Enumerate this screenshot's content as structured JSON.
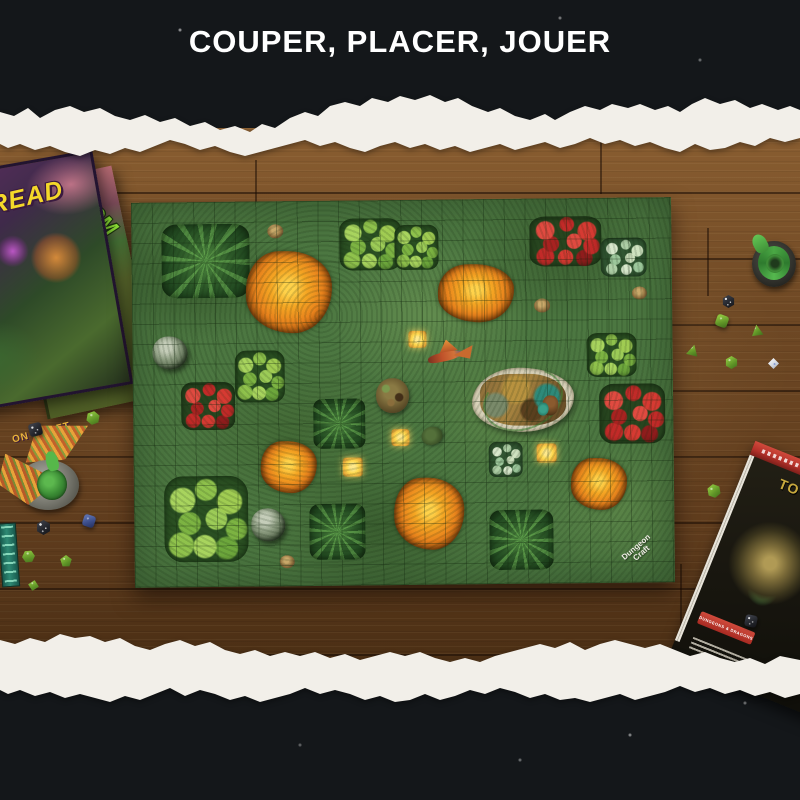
{
  "header": {
    "title": "COUPER, PLACER, JOUER"
  },
  "products": {
    "box_top": {
      "title_fragment": "E DREAD",
      "publisher_fragment": "ON CRAFT"
    },
    "box_bottom": {
      "title_fragment": "DOOM"
    },
    "mat_logo": {
      "line1": "Dungeon",
      "line2": "Craft"
    },
    "book": {
      "title_fragment": "TO",
      "logo_text": "DUNGEONS & DRAGONS"
    }
  },
  "colors": {
    "ink": "#14171a",
    "paper": "#f2efe9",
    "wood": "#6e4824",
    "wood_dark": "#4a2e14",
    "wood_light": "#8a5e31",
    "mat_green": "#4c7741",
    "lava": "#ef9420",
    "glow": "#ffd94f",
    "red_flower": "#c32a26",
    "leaf_light": "#9ccb57",
    "title_yellow": "#f4d829",
    "doom_green": "#96ef3a",
    "book_red": "#b5312a",
    "white": "#ffffff"
  },
  "scene": {
    "terrain": [
      {
        "t": "fern",
        "x": 30,
        "y": 22,
        "w": 88,
        "h": 74
      },
      {
        "t": "bush",
        "x": 208,
        "y": 18,
        "w": 62,
        "h": 52
      },
      {
        "t": "bush",
        "x": 263,
        "y": 25,
        "w": 44,
        "h": 45
      },
      {
        "t": "stump",
        "x": 136,
        "y": 23,
        "w": 16,
        "h": 14
      },
      {
        "t": "lava",
        "x": 114,
        "y": 50,
        "w": 86,
        "h": 82
      },
      {
        "t": "red",
        "x": 398,
        "y": 18,
        "w": 72,
        "h": 50
      },
      {
        "t": "pale",
        "x": 469,
        "y": 40,
        "w": 46,
        "h": 39
      },
      {
        "t": "lava",
        "x": 306,
        "y": 65,
        "w": 76,
        "h": 58
      },
      {
        "t": "stump",
        "x": 402,
        "y": 100,
        "w": 16,
        "h": 14
      },
      {
        "t": "stump",
        "x": 500,
        "y": 89,
        "w": 15,
        "h": 13
      },
      {
        "t": "boulder",
        "x": 20,
        "y": 134,
        "w": 35,
        "h": 33
      },
      {
        "t": "bush",
        "x": 102,
        "y": 149,
        "w": 50,
        "h": 52
      },
      {
        "t": "glow",
        "x": 276,
        "y": 131,
        "w": 18,
        "h": 17
      },
      {
        "t": "bush",
        "x": 454,
        "y": 135,
        "w": 50,
        "h": 44
      },
      {
        "t": "red",
        "x": 48,
        "y": 180,
        "w": 54,
        "h": 48
      },
      {
        "t": "fern",
        "x": 180,
        "y": 198,
        "w": 52,
        "h": 50
      },
      {
        "t": "ruin",
        "x": 339,
        "y": 169,
        "w": 102,
        "h": 64
      },
      {
        "t": "red",
        "x": 466,
        "y": 186,
        "w": 66,
        "h": 60
      },
      {
        "t": "glow",
        "x": 258,
        "y": 229,
        "w": 18,
        "h": 17
      },
      {
        "t": "lava",
        "x": 127,
        "y": 240,
        "w": 56,
        "h": 52
      },
      {
        "t": "glow",
        "x": 209,
        "y": 257,
        "w": 20,
        "h": 19
      },
      {
        "t": "pale",
        "x": 355,
        "y": 243,
        "w": 34,
        "h": 35
      },
      {
        "t": "glow",
        "x": 403,
        "y": 245,
        "w": 20,
        "h": 19
      },
      {
        "t": "lava",
        "x": 437,
        "y": 260,
        "w": 56,
        "h": 52
      },
      {
        "t": "bush",
        "x": 30,
        "y": 274,
        "w": 84,
        "h": 86
      },
      {
        "t": "lava",
        "x": 260,
        "y": 278,
        "w": 70,
        "h": 72
      },
      {
        "t": "boulder",
        "x": 117,
        "y": 307,
        "w": 34,
        "h": 33
      },
      {
        "t": "fern",
        "x": 175,
        "y": 303,
        "w": 56,
        "h": 56
      },
      {
        "t": "fern",
        "x": 355,
        "y": 311,
        "w": 64,
        "h": 60
      },
      {
        "t": "stump",
        "x": 145,
        "y": 354,
        "w": 15,
        "h": 13
      }
    ],
    "minis": [
      {
        "m": "dragon",
        "layer": "mat",
        "x": 293,
        "y": 144,
        "w": 48,
        "h": 24,
        "r": -6
      },
      {
        "m": "mound",
        "layer": "mat",
        "x": 243,
        "y": 178,
        "w": 33,
        "h": 35,
        "r": 0
      },
      {
        "m": "goblin",
        "layer": "mat",
        "x": 406,
        "y": 192,
        "w": 22,
        "h": 30,
        "r": 8
      },
      {
        "m": "turtle",
        "layer": "mat",
        "x": 288,
        "y": 227,
        "w": 21,
        "h": 18,
        "r": -15
      },
      {
        "m": "couatl",
        "layer": "photo",
        "x": 5,
        "y": 425,
        "w": 100,
        "h": 92,
        "r": 0
      },
      {
        "m": "snake",
        "layer": "photo",
        "x": 750,
        "y": 238,
        "w": 50,
        "h": 52,
        "r": 0
      },
      {
        "m": "ladder",
        "layer": "photo",
        "x": 0,
        "y": 523,
        "w": 16,
        "h": 62,
        "r": -4
      }
    ],
    "dice": [
      {
        "d": "d20",
        "c": "green",
        "x": 86,
        "y": 411,
        "s": 14,
        "r": 10
      },
      {
        "d": "d6",
        "c": "black",
        "x": 29,
        "y": 423,
        "s": 13,
        "r": -14
      },
      {
        "d": "d20",
        "c": "black",
        "x": 36,
        "y": 520,
        "s": 15,
        "r": 0
      },
      {
        "d": "d6",
        "c": "blue",
        "x": 83,
        "y": 515,
        "s": 12,
        "r": 18
      },
      {
        "d": "d20",
        "c": "green",
        "x": 22,
        "y": 550,
        "s": 13,
        "r": 25
      },
      {
        "d": "d12",
        "c": "green",
        "x": 60,
        "y": 555,
        "s": 12,
        "r": 0
      },
      {
        "d": "d8",
        "c": "green",
        "x": 28,
        "y": 580,
        "s": 11,
        "r": 12
      },
      {
        "d": "d20",
        "c": "black",
        "x": 722,
        "y": 295,
        "s": 13,
        "r": 0
      },
      {
        "d": "d6",
        "c": "green",
        "x": 716,
        "y": 315,
        "s": 12,
        "r": 20
      },
      {
        "d": "d4",
        "c": "green",
        "x": 751,
        "y": 324,
        "s": 12,
        "r": -8
      },
      {
        "d": "d4",
        "c": "green",
        "x": 687,
        "y": 344,
        "s": 12,
        "r": 14
      },
      {
        "d": "d20",
        "c": "green",
        "x": 725,
        "y": 356,
        "s": 13,
        "r": 0
      },
      {
        "d": "d8",
        "c": "white",
        "x": 768,
        "y": 358,
        "s": 11,
        "r": 0
      },
      {
        "d": "d20",
        "c": "green",
        "x": 707,
        "y": 484,
        "s": 14,
        "r": -10
      },
      {
        "d": "d6",
        "c": "black",
        "x": 745,
        "y": 615,
        "s": 12,
        "r": 12
      }
    ]
  }
}
